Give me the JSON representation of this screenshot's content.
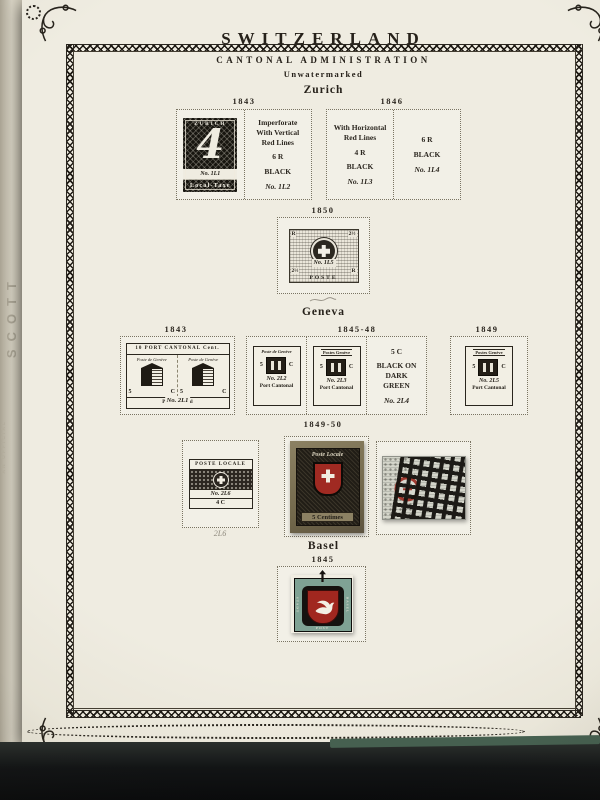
{
  "album": {
    "spine_text": "SCOTT",
    "spine_note": "AN OFFICIAL",
    "country_title": "SWITZERLAND",
    "section_title": "CANTONAL ADMINISTRATION",
    "watermark_note": "Unwatermarked"
  },
  "zurich": {
    "heading": "Zurich",
    "years": {
      "y1843": "1843",
      "y1846": "1846",
      "y1850": "1850"
    },
    "stamp_4r": {
      "top": "ZURICH",
      "numeral": "4",
      "number": "No. 1L1",
      "bottom": "Local-Taxe"
    },
    "space_1l2": {
      "l1": "Imperforate",
      "l2": "With Vertical",
      "l3": "Red Lines",
      "value": "6 R",
      "color": "BLACK",
      "number": "No. 1L2"
    },
    "space_1l3": {
      "l1": "With Horizontal",
      "l2": "Red Lines",
      "value": "4 R",
      "color": "BLACK",
      "number": "No. 1L3"
    },
    "space_1l4": {
      "value": "6 R",
      "color": "BLACK",
      "number": "No. 1L4"
    },
    "stamp_1850": {
      "corner_tl": "R",
      "corner_tr": "2½",
      "corner_bl": "2½",
      "corner_br": "R",
      "number": "No. 1L5",
      "bottom": "POSTE"
    }
  },
  "geneva": {
    "heading": "Geneva",
    "years": {
      "y1843": "1843",
      "y1845_48": "1845-48",
      "y1849": "1849",
      "y1849_50": "1849-50"
    },
    "double_geneva": {
      "top": "10 PORT CANTONAL Cent.",
      "half_label": "Poste de Genève",
      "value_5": "5",
      "value_c": "C",
      "number": "No. 2L1",
      "bottom": "Port Cantonal"
    },
    "space_2l2": {
      "top": "Poste de Genève",
      "number": "No. 2L2",
      "value_5": "5",
      "value_c": "C",
      "bottom": "Port Cantonal"
    },
    "space_2l3": {
      "top": "Postes Genève",
      "number": "No. 2L3",
      "value_5": "5",
      "value_c": "C",
      "bottom": "Port Cantonal"
    },
    "space_2l4": {
      "l1": "5 C",
      "l2": "BLACK ON",
      "l3": "DARK",
      "l4": "GREEN",
      "number": "No. 2L4"
    },
    "space_2l5": {
      "top": "Postes Genève",
      "number": "No. 2L5",
      "value_5": "5",
      "value_c": "C",
      "bottom": "Port Cantonal"
    },
    "space_2l6": {
      "top": "POSTE LOCALE",
      "number": "No. 2L6",
      "value": "4 C",
      "pencil": "2L6"
    },
    "stamp_5c": {
      "top": "Poste Locale",
      "bottom": "5 Centimes"
    }
  },
  "basel": {
    "heading": "Basel",
    "year": "1845",
    "stamp": {
      "left": "STADT",
      "bottom": "POST",
      "right": "BASEL"
    }
  },
  "colors": {
    "stamp_red": "#a1271f",
    "basel_teal": "#7fa294",
    "paper": "#efece1",
    "cover": "#101113"
  }
}
